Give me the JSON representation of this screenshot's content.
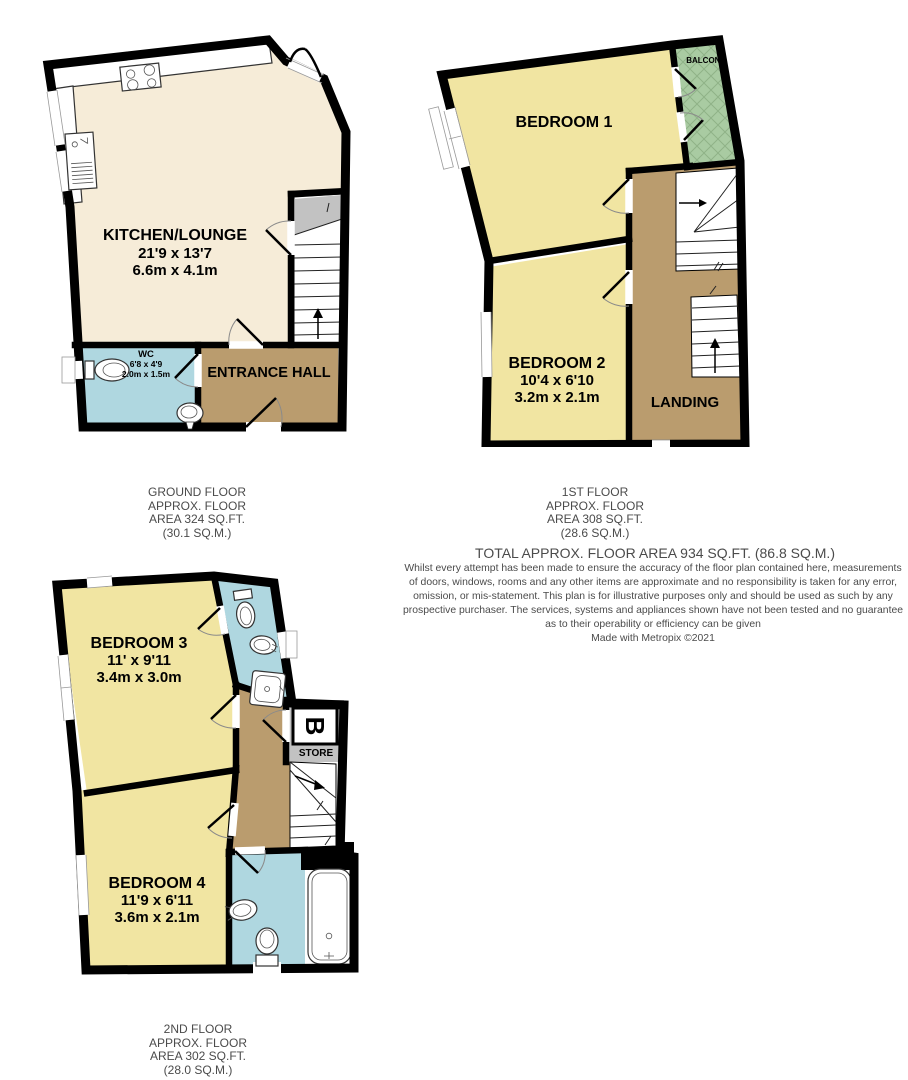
{
  "ground": {
    "caption": {
      "l1": "GROUND FLOOR",
      "l2": "APPROX. FLOOR",
      "l3": "AREA 324 SQ.FT.",
      "l4": "(30.1 SQ.M.)"
    },
    "kitchen": {
      "name": "KITCHEN/LOUNGE",
      "ft": "21'9 x 13'7",
      "m": "6.6m x 4.1m"
    },
    "wc": {
      "name": "WC",
      "ft": "6'8 x 4'9",
      "m": "2.0m x 1.5m"
    },
    "hall": {
      "name": "ENTRANCE HALL"
    }
  },
  "first": {
    "caption": {
      "l1": "1ST FLOOR",
      "l2": "APPROX. FLOOR",
      "l3": "AREA 308 SQ.FT.",
      "l4": "(28.6 SQ.M.)"
    },
    "bed1": {
      "name": "BEDROOM 1"
    },
    "bed2": {
      "name": "BEDROOM 2",
      "ft": "10'4 x 6'10",
      "m": "3.2m x 2.1m"
    },
    "landing": {
      "name": "LANDING"
    },
    "balcony": {
      "name": "BALCONY"
    }
  },
  "second": {
    "caption": {
      "l1": "2ND FLOOR",
      "l2": "APPROX. FLOOR",
      "l3": "AREA 302 SQ.FT.",
      "l4": "(28.0 SQ.M.)"
    },
    "bed3": {
      "name": "BEDROOM 3",
      "ft": "11' x 9'11",
      "m": "3.4m x 3.0m"
    },
    "bed4": {
      "name": "BEDROOM 4",
      "ft": "11'9 x 6'11",
      "m": "3.6m x 2.1m"
    },
    "store": {
      "name": "STORE",
      "boiler": "B"
    }
  },
  "summary": {
    "total": "TOTAL APPROX. FLOOR AREA 934 SQ.FT. (86.8 SQ.M.)",
    "disclaimer": [
      "Whilst every attempt has been made to ensure the accuracy of the floor plan contained here, measurements",
      "of doors, windows, rooms and any other items are approximate and no responsibility is taken for any error,",
      "omission, or mis-statement. This plan is for illustrative purposes only and should be used as such by any",
      "prospective purchaser. The services, systems and appliances shown have not been tested and no guarantee",
      "as to their operability or efficiency can be given"
    ],
    "credit": "Made with Metropix ©2021"
  },
  "colors": {
    "wall": "#000000",
    "kitchen_floor": "#F6ECD8",
    "bedroom_floor": "#F1E5A2",
    "bathroom_floor": "#AFD7E0",
    "hall_floor": "#BA9C6E",
    "balcony": "#A9CBA2",
    "stair_gray": "#C2C2C2"
  }
}
